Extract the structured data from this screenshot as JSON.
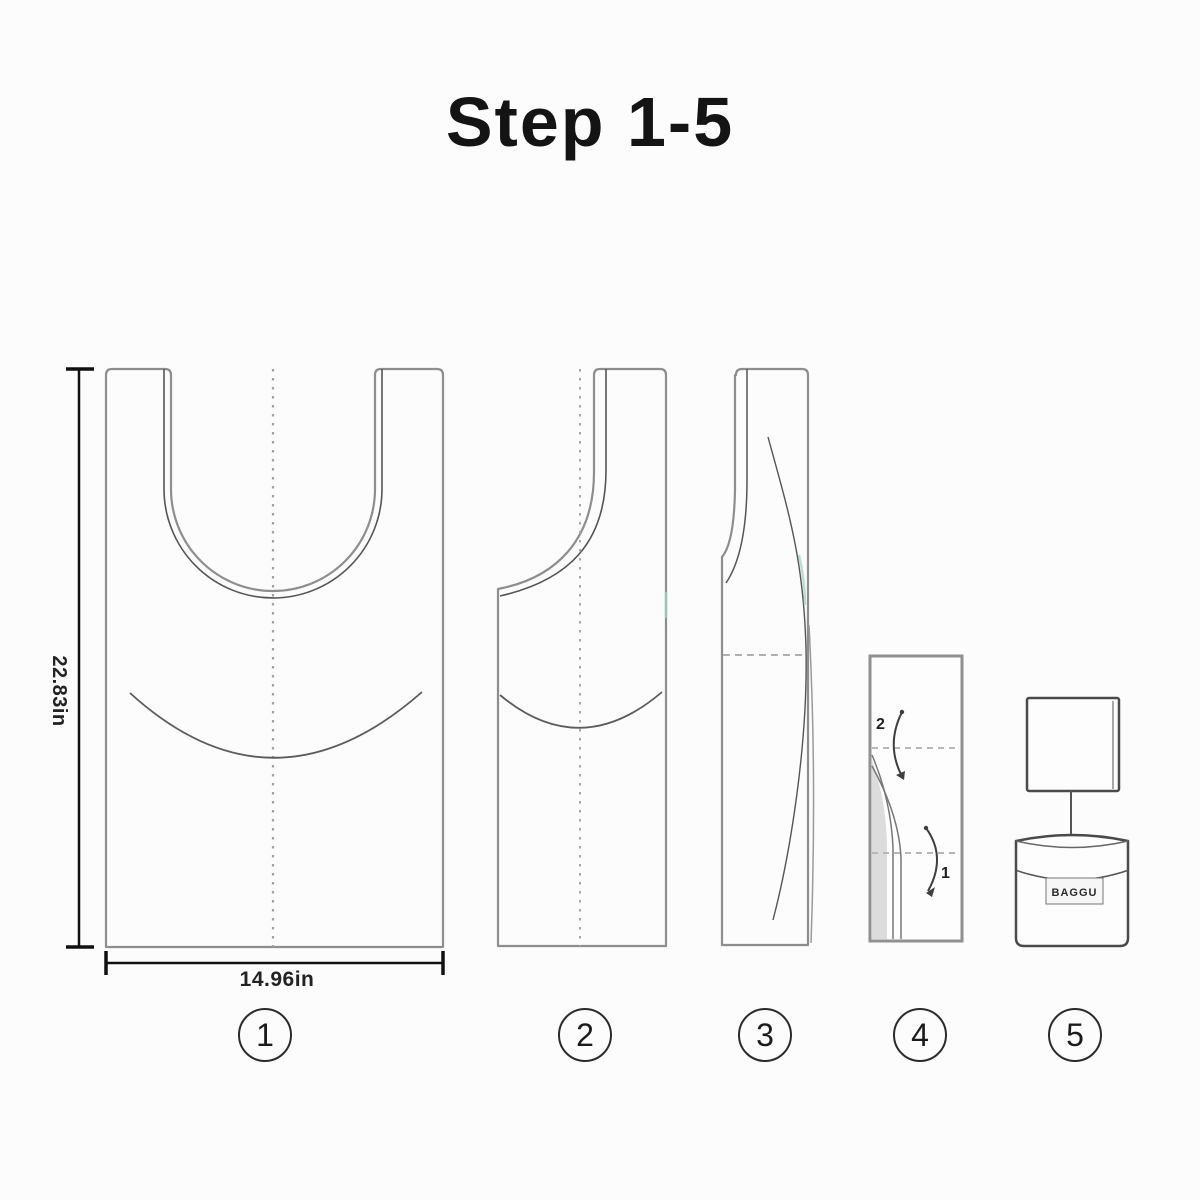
{
  "title": "Step 1-5",
  "dimension_labels": {
    "height": "22.83in",
    "width": "14.96in"
  },
  "fold_labels": {
    "second_fold": "2",
    "first_fold": "1"
  },
  "brand_label": "BAGGU",
  "steps": [
    {
      "number": "1"
    },
    {
      "number": "2"
    },
    {
      "number": "3"
    },
    {
      "number": "4"
    },
    {
      "number": "5"
    }
  ],
  "colors": {
    "background": "#fcfcfc",
    "line_dark": "#4f4f4f",
    "line_mid": "#8e8e8e",
    "line_light": "#b0b0b0",
    "dimension_line": "#111111",
    "teal_accent": "#9ed2c6",
    "shade_gray": "#dcdcdc",
    "text": "#1c1c1c"
  }
}
